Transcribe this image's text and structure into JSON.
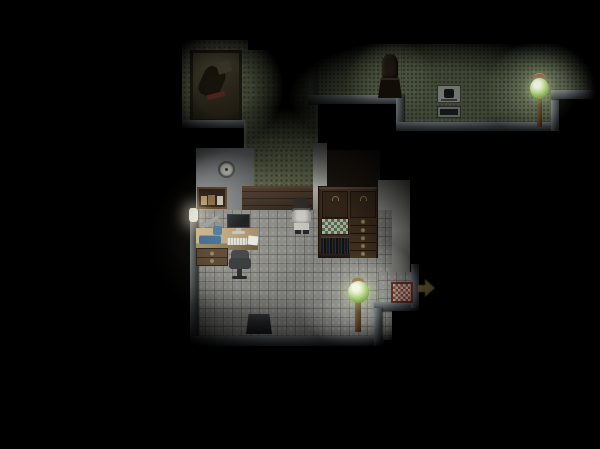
{
  "scene": {
    "description": "Dark top-down pixel RPG interior: lamplit study room with desk, computer, character in white coat and wooden hutch; green-wallpapered annex with framed painting; upper hallway with bust statue, small stove and green floor lamp; red checkered doormat and dim golden exit arrow on the right.",
    "viewport": {
      "width": 600,
      "height": 449
    }
  },
  "colors": {
    "background": "#000000",
    "wallpaper_green": "#5c634b",
    "hallway_floor_green": "#57604a",
    "floor_tile_gray": "#8d8d89",
    "wainscot_brown": "#42332a",
    "north_wall_gray": "#84898c",
    "right_wall_white": "#b0b0a8",
    "doorframe_white": "#a8aaa0",
    "wall_edge_gray": "#565c60",
    "cabinet_wood": "#46362a",
    "desk_wood": "#b4925e",
    "underdesk_wood": "#55412e",
    "shelf_wood": "#5e4228",
    "lamp_glass_green": "#8cb84e",
    "lamp_post_brown": "#5c4026",
    "doormat_check_red": "#8c4640",
    "doormat_base": "#c6b2a6",
    "arrow_gold": "#847040",
    "character_coat": "#dad9d2",
    "monitor_screen": "#14171b",
    "instrument_blue": "#3c6c94",
    "dark_wall": "#1c1710"
  },
  "objects": {
    "painting": {
      "label": "framed wall painting"
    },
    "wall_clock": {
      "label": "round wall clock"
    },
    "wall_shelf": {
      "label": "wooden wall shelf with items"
    },
    "desk_light": {
      "label": "small bright desk light"
    },
    "desk": {
      "label": "study desk"
    },
    "monitor": {
      "label": "computer monitor"
    },
    "keyboard": {
      "label": "keyboard"
    },
    "paper": {
      "label": "loose paper"
    },
    "instrument": {
      "label": "blue lab instrument"
    },
    "desk_drawers": {
      "label": "under-desk drawers"
    },
    "chair": {
      "label": "dark office chair"
    },
    "character": {
      "label": "character in white coat"
    },
    "cabinet": {
      "label": "wooden cabinet hutch"
    },
    "cabinet_door": {
      "label": "upper cabinet door"
    },
    "bottle_shelf": {
      "label": "tiled bottle shelf"
    },
    "books": {
      "label": "row of dark books"
    },
    "drawers": {
      "label": "cabinet drawers"
    },
    "stool": {
      "label": "dark stool against bottom wall"
    },
    "floor_lamp_room": {
      "label": "green glass floor lamp (room)"
    },
    "floor_lamp_hall": {
      "label": "green glass floor lamp (hallway)"
    },
    "doormat": {
      "label": "red checkered doormat exit"
    },
    "exit_arrow": {
      "label": "golden exit arrow pointing right"
    },
    "statue": {
      "label": "dark bust statue on pedestal"
    },
    "stove": {
      "label": "small iron stove"
    }
  },
  "lighting": {
    "sources": [
      {
        "name": "desk-light",
        "x": 224,
        "y": 232
      },
      {
        "name": "room-floor-lamp",
        "x": 359,
        "y": 293
      },
      {
        "name": "hall-floor-lamp",
        "x": 540,
        "y": 91
      },
      {
        "name": "hall-ambient",
        "x": 440,
        "y": 96
      },
      {
        "name": "painting-glow",
        "x": 222,
        "y": 88
      }
    ]
  }
}
